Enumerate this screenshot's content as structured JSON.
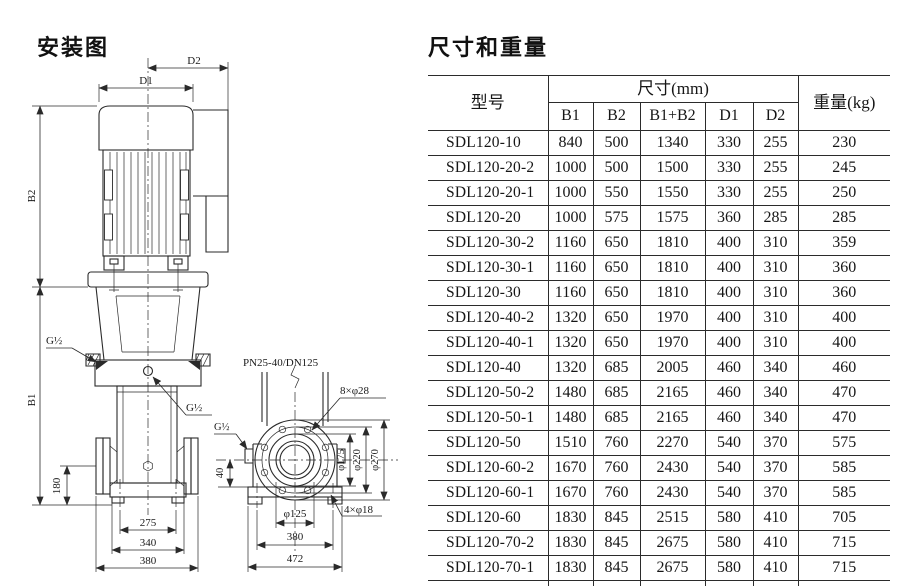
{
  "diagram": {
    "title": "安装图",
    "labels": {
      "d1": "D1",
      "d2": "D2",
      "b1": "B1",
      "b2": "B2",
      "g_left": "G½",
      "g_drain": "G½",
      "g_gauge": "G½",
      "h180": "180",
      "w275": "275",
      "w340": "340",
      "w380_front": "380",
      "flange_spec": "PN25-40/DN125",
      "flange_bolt_holes": "8×φ28",
      "h40": "40",
      "d175": "φ175",
      "d220": "φ220",
      "d270": "φ270",
      "d125": "φ125",
      "base_bolt_holes": "4×φ18",
      "w380_base": "380",
      "w472": "472"
    }
  },
  "table": {
    "title": "尺寸和重量",
    "headers": {
      "model": "型号",
      "dims_group": "尺寸(mm)",
      "cols": [
        "B1",
        "B2",
        "B1+B2",
        "D1",
        "D2"
      ],
      "weight": "重量(kg)"
    },
    "rows": [
      [
        "SDL120-10",
        "840",
        "500",
        "1340",
        "330",
        "255",
        "230"
      ],
      [
        "SDL120-20-2",
        "1000",
        "500",
        "1500",
        "330",
        "255",
        "245"
      ],
      [
        "SDL120-20-1",
        "1000",
        "550",
        "1550",
        "330",
        "255",
        "250"
      ],
      [
        "SDL120-20",
        "1000",
        "575",
        "1575",
        "360",
        "285",
        "285"
      ],
      [
        "SDL120-30-2",
        "1160",
        "650",
        "1810",
        "400",
        "310",
        "359"
      ],
      [
        "SDL120-30-1",
        "1160",
        "650",
        "1810",
        "400",
        "310",
        "360"
      ],
      [
        "SDL120-30",
        "1160",
        "650",
        "1810",
        "400",
        "310",
        "360"
      ],
      [
        "SDL120-40-2",
        "1320",
        "650",
        "1970",
        "400",
        "310",
        "400"
      ],
      [
        "SDL120-40-1",
        "1320",
        "650",
        "1970",
        "400",
        "310",
        "400"
      ],
      [
        "SDL120-40",
        "1320",
        "685",
        "2005",
        "460",
        "340",
        "460"
      ],
      [
        "SDL120-50-2",
        "1480",
        "685",
        "2165",
        "460",
        "340",
        "470"
      ],
      [
        "SDL120-50-1",
        "1480",
        "685",
        "2165",
        "460",
        "340",
        "470"
      ],
      [
        "SDL120-50",
        "1510",
        "760",
        "2270",
        "540",
        "370",
        "575"
      ],
      [
        "SDL120-60-2",
        "1670",
        "760",
        "2430",
        "540",
        "370",
        "585"
      ],
      [
        "SDL120-60-1",
        "1670",
        "760",
        "2430",
        "540",
        "370",
        "585"
      ],
      [
        "SDL120-60",
        "1830",
        "845",
        "2515",
        "580",
        "410",
        "705"
      ],
      [
        "SDL120-70-2",
        "1830",
        "845",
        "2675",
        "580",
        "410",
        "715"
      ],
      [
        "SDL120-70-1",
        "1830",
        "845",
        "2675",
        "580",
        "410",
        "715"
      ],
      [
        "SDL120-70",
        "1830",
        "845",
        "2675",
        "580",
        "410",
        "715"
      ]
    ]
  }
}
